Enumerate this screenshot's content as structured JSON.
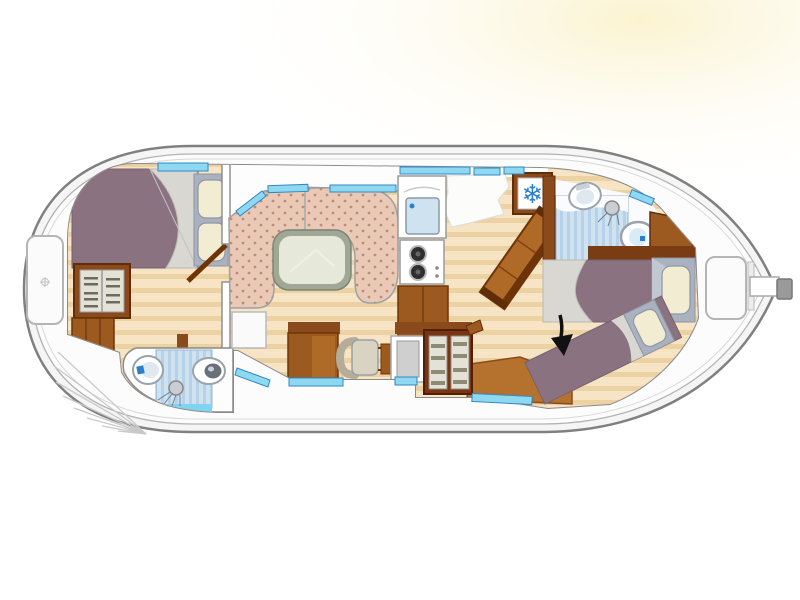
{
  "figure": {
    "kind": "boat-floor-plan"
  },
  "icons": {
    "snowflake": "❄"
  },
  "palette": {
    "background": "#ffffff",
    "glow": "#fbf2cd",
    "hull_fill": "#f5f5f5",
    "hull_stroke": "#808080",
    "hull_inner_fill": "#fcfcfc",
    "hull_inner_stroke": "#b2b2b2",
    "hull_faint": "#d8d8d8",
    "cabin_fill": "#ffffff",
    "wall_stroke": "#8a8a8a",
    "wood_base": "#f6e4c4",
    "wood_stripe": "#ecd1a2",
    "wood_wall": "#8a4a1c",
    "wood_wall_dark": "#5f2d08",
    "wood_mid": "#9c5a20",
    "wood_light": "#b06a28",
    "floor_brown": "#b5722e",
    "bench": "#eac9b6",
    "bench_dot": "#bd8d77",
    "table_rim": "#9fa895",
    "table_top": "#e6e9da",
    "bed": "#8b7280",
    "blanket": "#d8d7d2",
    "pillow": "#f2ecd2",
    "pillow_frame": "#aab1bf",
    "shower_base": "#cfe2f0",
    "shower_stripe": "#b7d2e8",
    "shower_sill": "#7fd4f2",
    "window_fill": "#8fd8f2",
    "window_stroke": "#3188c4",
    "fixture": "#ffffff",
    "fixture_stroke": "#9aa2ac",
    "basin": "#dfe8ee",
    "bowl": "#6b7078",
    "accent_blue": "#2b7fd0",
    "appliance": "#cfcfcf",
    "shelf_bg": "#e4e1d6",
    "shelf_item": "#8f8a74",
    "chair": "#d9d3c2",
    "metal": "#c9ced4",
    "arrow": "#111111",
    "locker": "#fbfbfb",
    "rudder": "#9a9a9a",
    "burner": "#2f2f2f"
  }
}
